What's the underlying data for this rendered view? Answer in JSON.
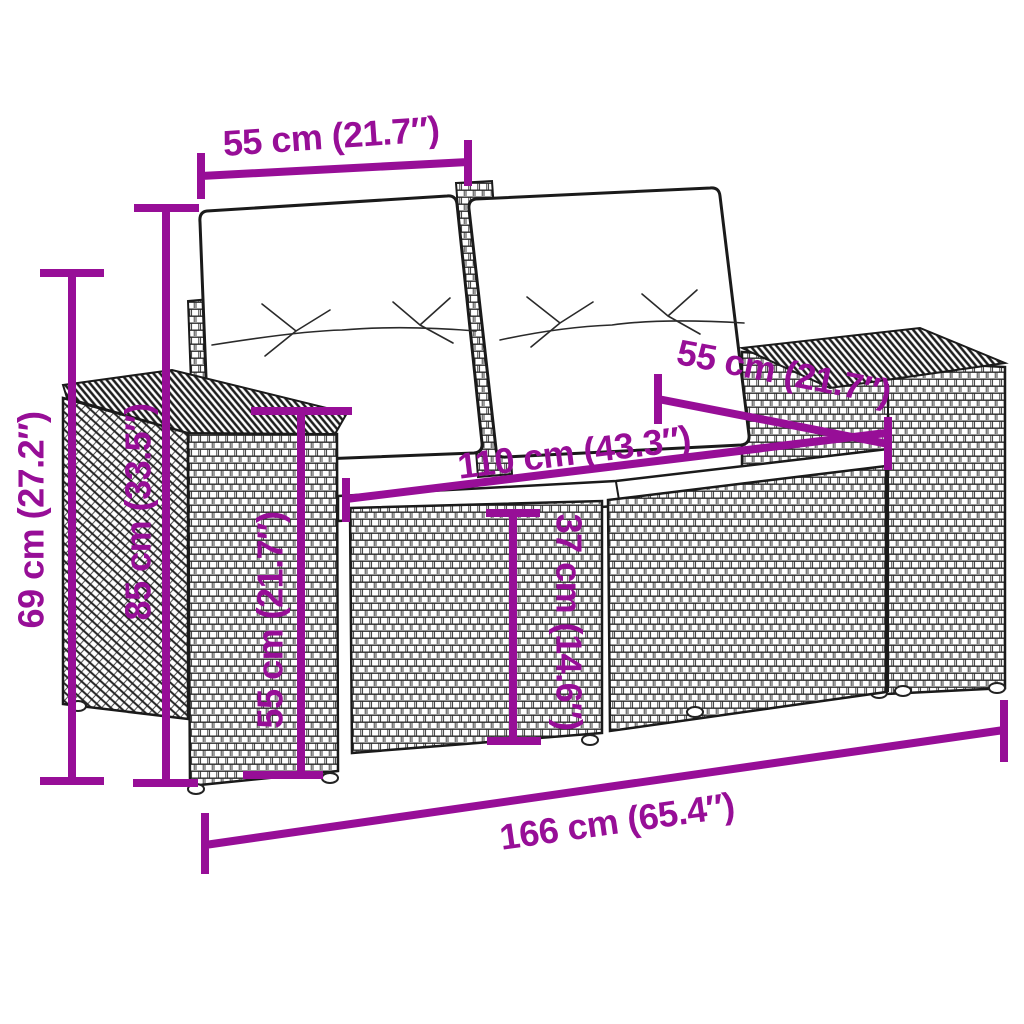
{
  "figure": {
    "type": "product-dimension-diagram",
    "subject": "rattan garden sofa with cushions"
  },
  "colors": {
    "dimension": "#970E97",
    "line_art": "#1A1A1A",
    "background": "#FFFFFF"
  },
  "dims": {
    "backrest_width": {
      "text": "55 cm (21.7″)"
    },
    "depth": {
      "text": "55 cm (21.7″)"
    },
    "seat_width": {
      "text": "110 cm (43.3″)"
    },
    "total_width": {
      "text": "166 cm (65.4″)"
    },
    "height_total": {
      "text": "69 cm (27.2″)"
    },
    "height_back": {
      "text": "85 cm (33.5″)"
    },
    "height_armrest": {
      "text": "55 cm (21.7″)"
    },
    "height_seat": {
      "text": "37 cm (14.6″)"
    }
  }
}
